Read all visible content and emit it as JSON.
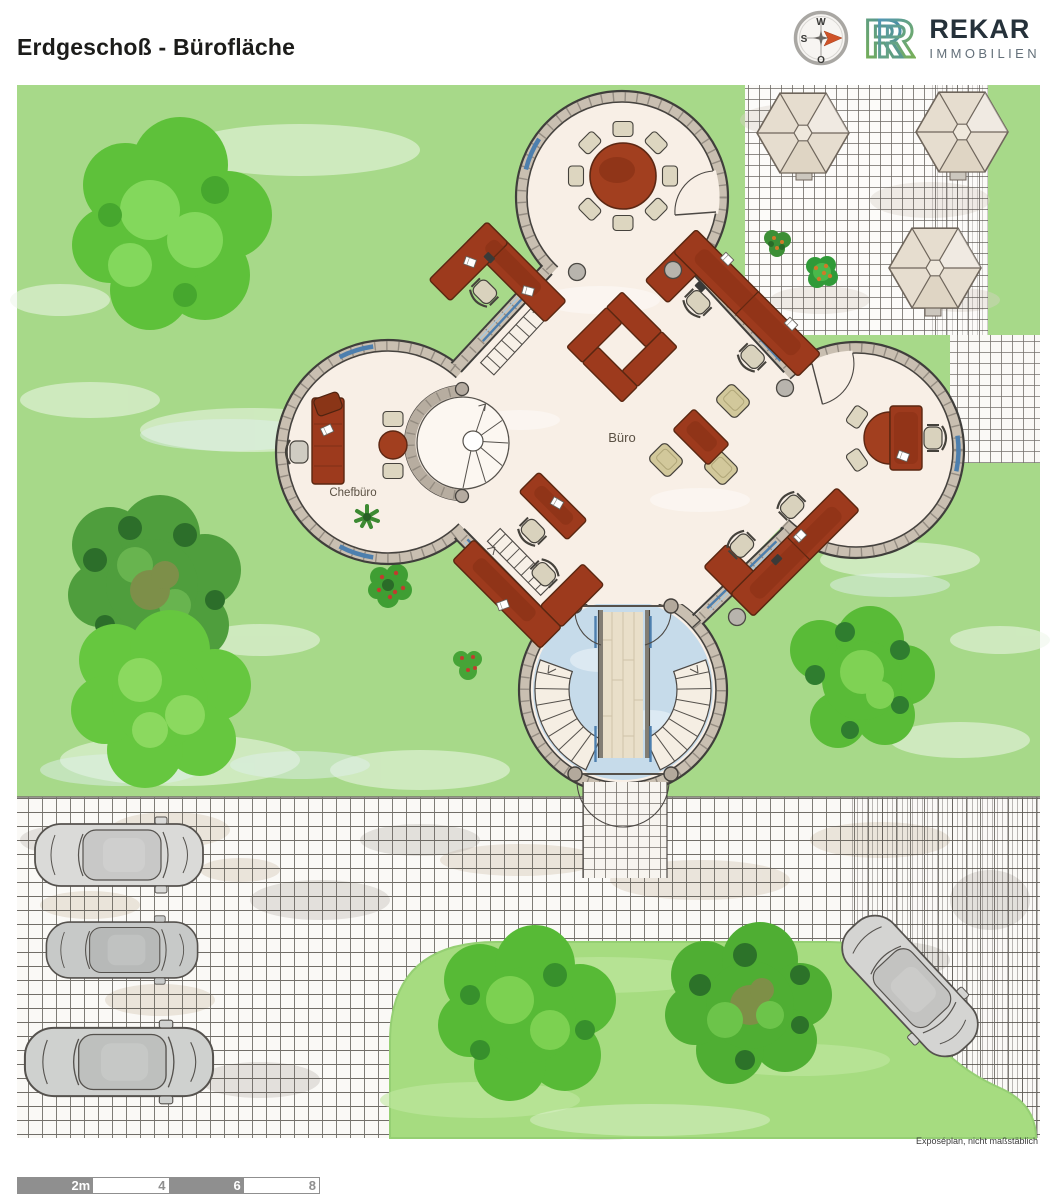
{
  "header": {
    "title": "Erdgeschoß - Bürofläche"
  },
  "brand": {
    "name": "REKAR",
    "subtitle": "IMMOBILIEN"
  },
  "compass": {
    "west": "W",
    "south": "S",
    "east": "O"
  },
  "plan": {
    "labels": {
      "office": "Büro",
      "chef_office": "Chefbüro"
    }
  },
  "footer": {
    "disclaimer": "Exposéplan, nicht maßstäblich",
    "scalebar": {
      "labels": [
        "2m",
        "4",
        "6",
        "8"
      ]
    }
  },
  "colors": {
    "lawn": "#a7d989",
    "wall": "#c9bfb1",
    "interior": "#f8efe6",
    "desk": "#9d3a1d",
    "window_blue": "#4d7fae",
    "glass_floor": "#c6dbea",
    "tree_green": "#5ec13a",
    "scalebar_gray": "#8f8f8f",
    "compass_arrow": "#cf5227",
    "logo_green": "#7cb34a",
    "logo_blue": "#3f86bf"
  }
}
